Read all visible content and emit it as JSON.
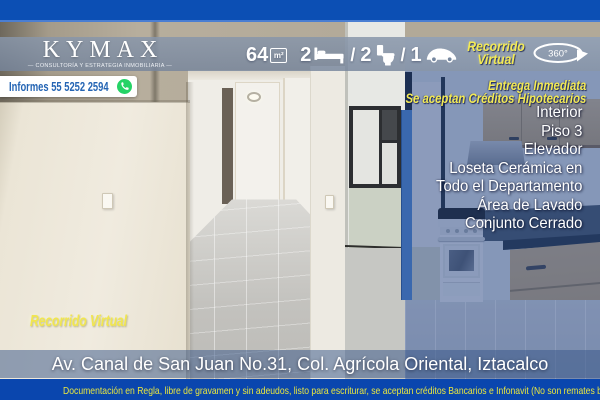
{
  "brand": {
    "name": "KYMAX",
    "tagline": "— CONSULTORÍA Y ESTRATEGIA INMOBILIARIA —"
  },
  "contact": {
    "label": "Informes 55 5252 2594"
  },
  "stats": {
    "area_value": "64",
    "area_unit": "m²",
    "bedrooms": "2",
    "bathrooms": "2",
    "parking": "1",
    "separator": "/"
  },
  "virtual_tour": {
    "line1": "Recorrido",
    "line2": "Virtual",
    "badge": "360°",
    "bottom_label": "Recorrido Virtual"
  },
  "highlights": {
    "line1": "Entrega Inmediata",
    "line2": "Se aceptan Créditos Hipotecarios"
  },
  "features": [
    "Interior",
    "Piso 3",
    "Elevador",
    "Loseta Cerámica en",
    "Todo el Departamento",
    "Área de Lavado",
    "Conjunto Cerrado"
  ],
  "address": "Av. Canal de San Juan No.31, Col. Agrícola Oriental, Iztacalco",
  "footer": "Documentación en Regla, libre de gravamen y sin adeudos, listo para escriturar, se aceptan créditos Bancarios e Infonavit (No son remates bancarios)",
  "colors": {
    "top_bar": "#0c4fb4",
    "footer_bar": "#0a46ae",
    "accent_yellow": "#f2e955",
    "whatsapp_green": "#25d366",
    "contact_text_blue": "#2565b4",
    "overlay_blue": "rgba(27,58,125,0.45)"
  }
}
